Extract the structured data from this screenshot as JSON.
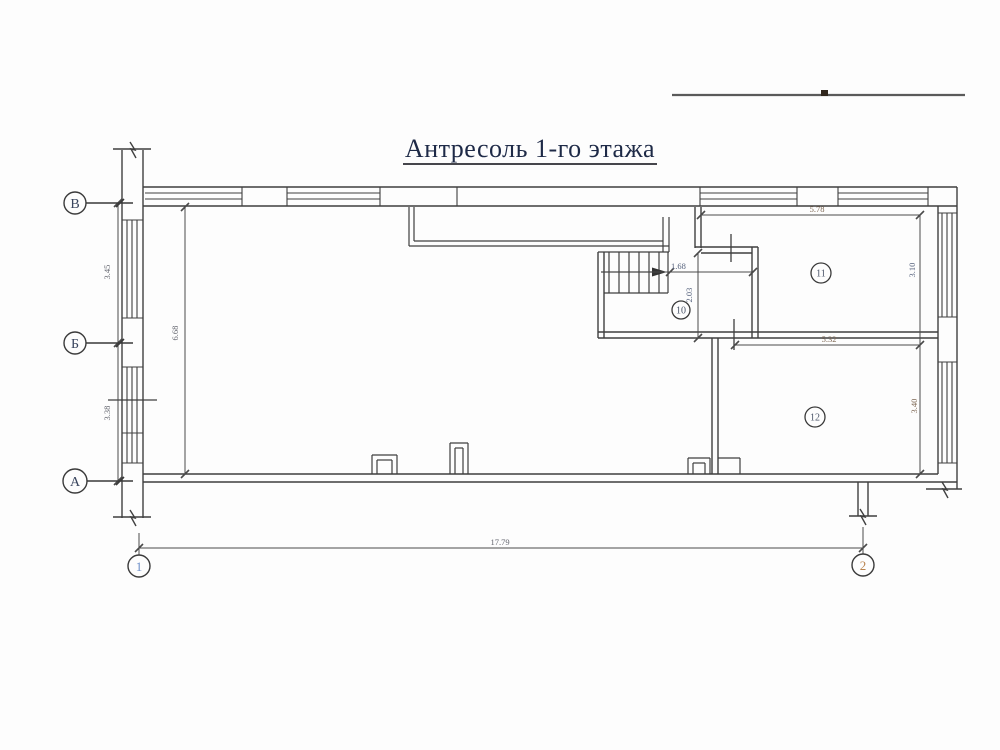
{
  "title": "Антресоль 1-го этажа",
  "axes": {
    "row_v": "В",
    "row_b": "Б",
    "row_a": "А",
    "col_1": "1",
    "col_2": "2"
  },
  "rooms": {
    "r10": "10",
    "r11": "11",
    "r12": "12"
  },
  "dimensions": {
    "left_upper": "3.45",
    "left_lower": "3.38",
    "hall_depth": "6.68",
    "stair_width": "1.68",
    "stair_depth": "2.03",
    "top_width": "5.78",
    "right_upper": "3.10",
    "mid_width": "5.32",
    "right_lower": "3.40",
    "overall_width": "17.79"
  },
  "colors": {
    "ink": "#3f3f3f",
    "title_ink": "#1e2a47",
    "axis_digit_1": "#6d8fc9",
    "axis_digit_2": "#b9834d"
  }
}
